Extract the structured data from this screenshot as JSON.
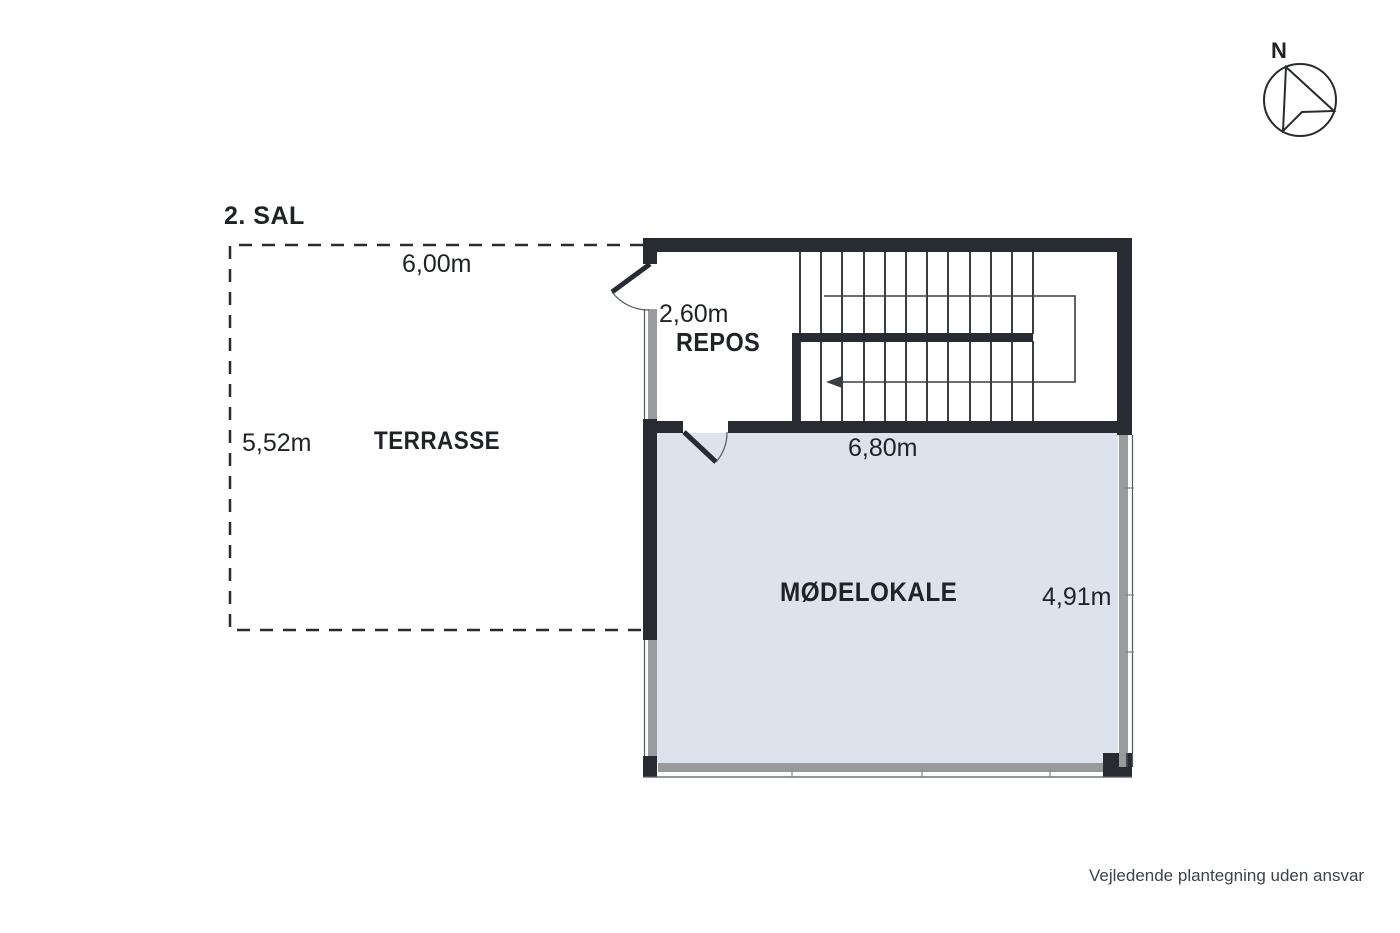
{
  "floor_label": "2. SAL",
  "compass": {
    "label": "N"
  },
  "rooms": {
    "terrasse": {
      "name": "TERRASSE",
      "width_label": "6,00m",
      "height_label": "5,52m"
    },
    "repos": {
      "name": "REPOS",
      "width_label": "2,60m"
    },
    "moedelokale": {
      "name": "MØDELOKALE",
      "width_label": "6,80m",
      "height_label": "4,91m"
    }
  },
  "disclaimer": "Vejledende plantegning uden ansvar",
  "colors": {
    "wall": "#282b31",
    "floor": "#dde3ec",
    "window_sill": "#9b9b9b",
    "window_frame": "#555a60",
    "stair_line": "#3a3d42",
    "text": "#1f2226",
    "disclaimer_text": "#3d424a"
  }
}
